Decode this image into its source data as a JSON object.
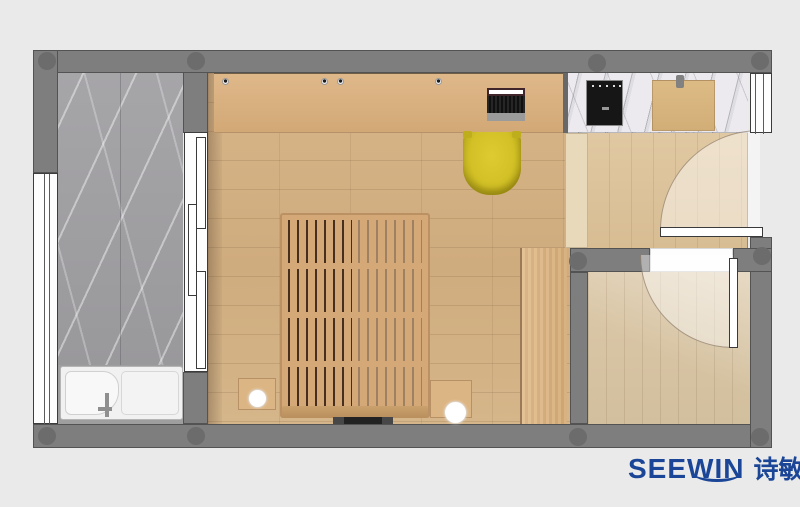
{
  "brand": {
    "latin": "SEEWIN",
    "cjk": "诗敏",
    "color": "#1b4697"
  },
  "palette": {
    "canvas_background": "#eaeaea",
    "wall": "#7e7e7e",
    "wall_column": "#6c6c6c",
    "bathroom_marble": "#a19fa3",
    "counter_marble": "#eceaee",
    "main_wood_floor": "#d3b184",
    "desk_wood": "#d8b082",
    "entry_wood_floor": "#ddc39b",
    "small_room_wood_floor": "#d9c7a7",
    "bed_wood": "#d5a977",
    "wardrobe_wood": "#dcb27f",
    "chair_yellow": "#d2c026",
    "cooktop_black": "#161616",
    "chopping_board_wood": "#d9b67f",
    "bathtub_white": "#f1f1f2",
    "door_leaf_white": "#ffffff"
  },
  "elements": {
    "furniture": [
      "bathtub",
      "sliding-door",
      "platform-bed",
      "bedside-table",
      "bedside-lamp",
      "tv",
      "desk-cabinet",
      "laptop",
      "desk-chair",
      "kitchen-counter",
      "cooktop",
      "chopping-board",
      "shoe-cabinet",
      "wardrobe",
      "entry-door",
      "room-door",
      "window",
      "wall-column"
    ]
  }
}
